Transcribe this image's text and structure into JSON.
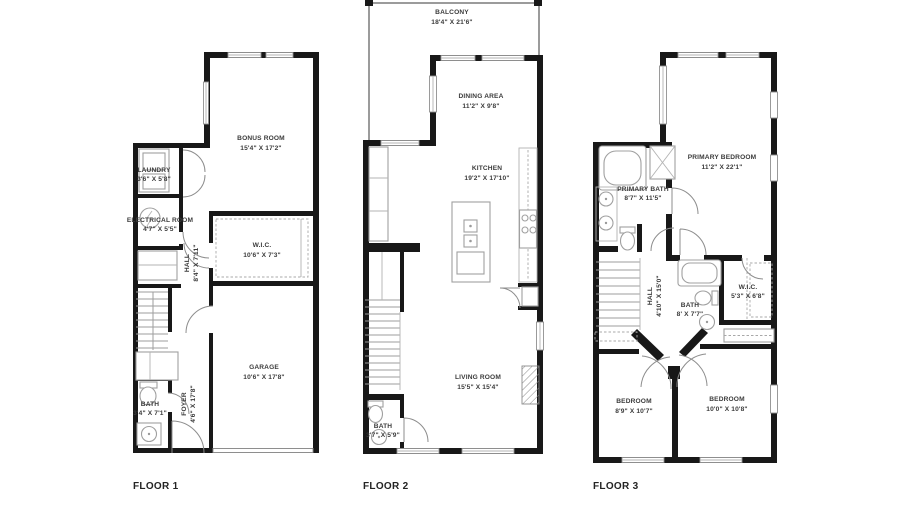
{
  "colors": {
    "background": "#ffffff",
    "wall": "#181818",
    "fixture_stroke": "#a0a0a0",
    "text": "#3b3b3b",
    "floor_label": "#242424"
  },
  "floors": [
    {
      "label": "FLOOR 1",
      "rooms": {
        "bonus": {
          "name": "BONUS ROOM",
          "dims": "15'4\" X 17'2\""
        },
        "laundry": {
          "name": "LAUNDRY",
          "dims": "3'6\" X 5'8\""
        },
        "electrical": {
          "name": "ELECTRICAL ROOM",
          "dims": "4'7\" X 5'5\""
        },
        "hall": {
          "name": "HALL",
          "dims": "8'4\" X 7'11\""
        },
        "wic": {
          "name": "W.I.C.",
          "dims": "10'6\" X 7'3\""
        },
        "garage": {
          "name": "GARAGE",
          "dims": "10'6\" X 17'8\""
        },
        "bath": {
          "name": "BATH",
          "dims": "3'4\" X 7'1\""
        },
        "foyer": {
          "name": "FOYER",
          "dims": "4'6\" X 17'8\""
        }
      }
    },
    {
      "label": "FLOOR 2",
      "rooms": {
        "balcony": {
          "name": "BALCONY",
          "dims": "18'4\" X 21'6\""
        },
        "dining": {
          "name": "DINING AREA",
          "dims": "11'2\" X 9'8\""
        },
        "kitchen": {
          "name": "KITCHEN",
          "dims": "19'2\" X 17'10\""
        },
        "living": {
          "name": "LIVING ROOM",
          "dims": "15'5\" X 15'4\""
        },
        "bath": {
          "name": "BATH",
          "dims": "3'7\" X 5'9\""
        }
      }
    },
    {
      "label": "FLOOR 3",
      "rooms": {
        "primary_bedroom": {
          "name": "PRIMARY BEDROOM",
          "dims": "11'2\" X 22'1\""
        },
        "primary_bath": {
          "name": "PRIMARY BATH",
          "dims": "8'7\" X 11'5\""
        },
        "hall": {
          "name": "HALL",
          "dims": "4'10\" X 15'0\""
        },
        "bath": {
          "name": "BATH",
          "dims": "8' X 7'7\""
        },
        "wic": {
          "name": "W.I.C.",
          "dims": "5'3\" X 6'8\""
        },
        "bedroom_left": {
          "name": "BEDROOM",
          "dims": "8'9\" X 10'7\""
        },
        "bedroom_right": {
          "name": "BEDROOM",
          "dims": "10'0\" X 10'8\""
        }
      }
    }
  ]
}
